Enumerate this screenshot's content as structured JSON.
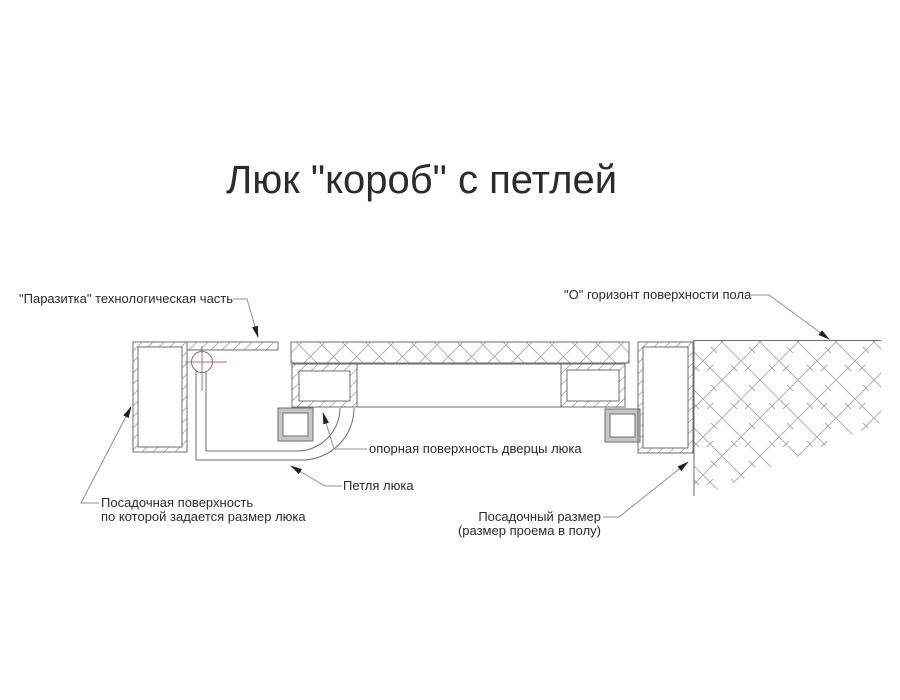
{
  "title": "Люк \"короб\" с петлей",
  "labels": {
    "parasitka": "\"Паразитка\" технологическая часть",
    "horizon": "\"О\" горизонт поверхности пола",
    "support_surface": "опорная поверхность дверцы люка",
    "hinge": "Петля люка",
    "seating_surface_line1": "Посадочная поверхность",
    "seating_surface_line2": "по которой задается размер люка",
    "seating_size_line1": "Посадочный размер",
    "seating_size_line2": "(размер проема в полу)"
  },
  "colors": {
    "line": "#6e6e6e",
    "hatch": "#a8a8a8",
    "leader": "#8f8f8f",
    "arrow": "#222222",
    "text": "#2b2b2b",
    "accent_red": "#c06868",
    "seal_gray": "#c6c6c6"
  }
}
